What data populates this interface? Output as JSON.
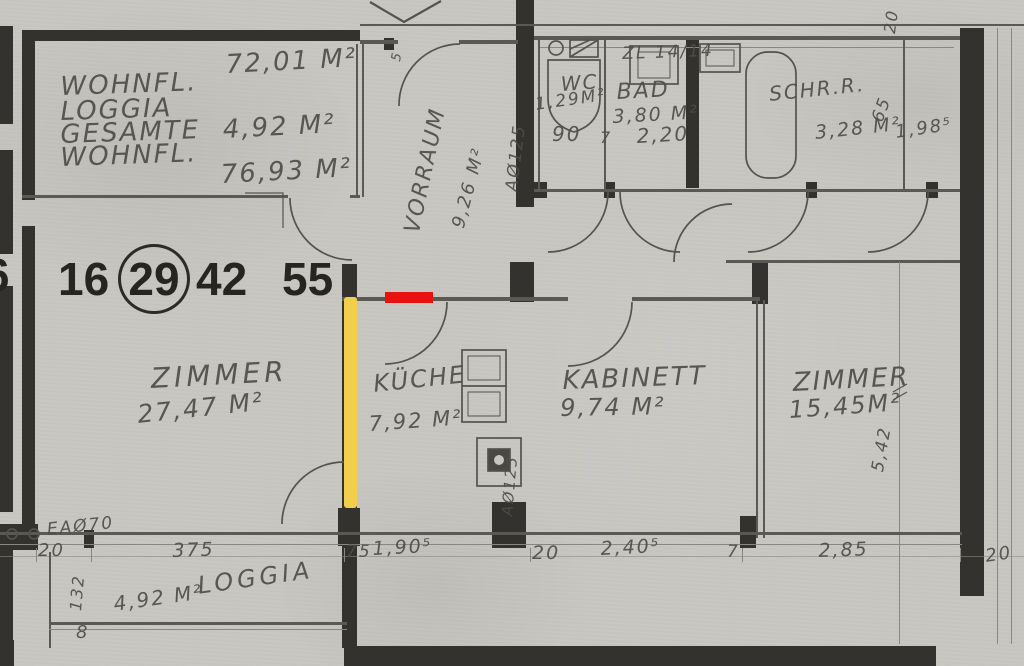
{
  "annotations": {
    "red": "#e8120e",
    "yellow": "#f1ce4c"
  },
  "title_block": {
    "label1": "WOHNFL.",
    "value1": "72,01 M²",
    "label2": "LOGGIA",
    "value2": "4,92 M²",
    "label3": "GESAMTE",
    "label4": "WOHNFL.",
    "value3": "76,93 M²"
  },
  "unit_numbers": {
    "partial": "6",
    "n1": "16",
    "n2": "29",
    "n3": "42",
    "n4": "55"
  },
  "rooms": {
    "vorraum": {
      "name": "VORRAUM",
      "area": "9,26 M²"
    },
    "wc": {
      "name": "WC",
      "area": "1,29M²",
      "width": "90"
    },
    "bad": {
      "name": "BAD",
      "area": "3,80 M²",
      "dim_small": "7",
      "dim_width": "2,20",
      "vent": "ZL 14/14"
    },
    "schrankraum": {
      "name": "SCHR.R.",
      "area": "3,28 M²",
      "dim_depth": "65",
      "dim_width": "1,98⁵"
    },
    "zimmer_left": {
      "name": "ZIMMER",
      "area": "27,47 M²"
    },
    "kueche": {
      "name": "KÜCHE",
      "area": "7,92 M²"
    },
    "kabinett": {
      "name": "KABINETT",
      "area": "9,74 M²"
    },
    "zimmer_right": {
      "name": "ZIMMER",
      "area": "15,45M²",
      "dim_height": "5,42"
    },
    "loggia": {
      "name": "LOGGIA",
      "area": "4,92 M²"
    }
  },
  "shafts": {
    "vorraum_duct": "AØ125",
    "kueche_duct": "AØ125",
    "loggia_duct": "EAØ70"
  },
  "dims": {
    "top_20": "20",
    "jamb_5": "5",
    "b_20a": "20",
    "b_132": "132",
    "b_375": "375",
    "b_75": "75",
    "b_190": "1,90⁵",
    "b_20b": "20",
    "b_240": "2,40⁵",
    "b_7": "7",
    "b_285": "2,85",
    "b_20c": "20",
    "b_8": "8"
  }
}
